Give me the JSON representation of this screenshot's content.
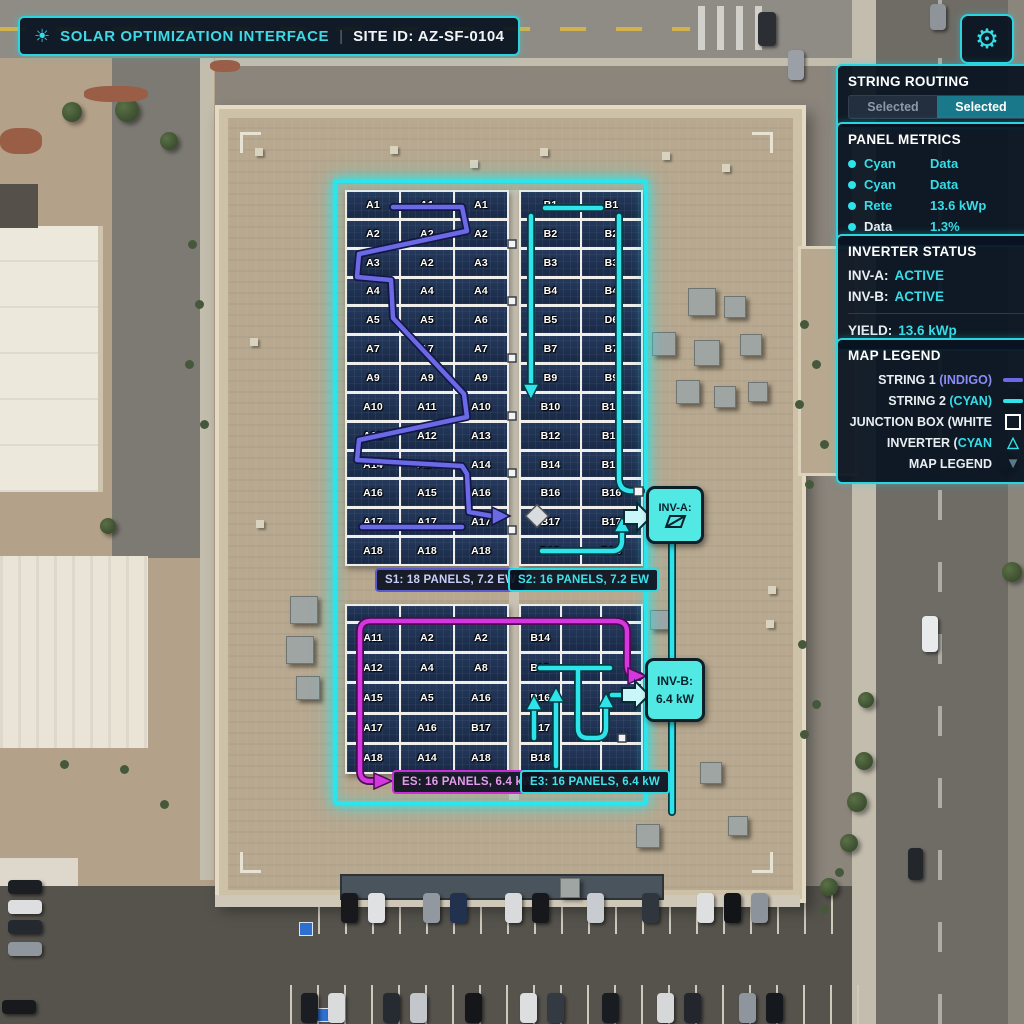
{
  "header": {
    "title": "SOLAR OPTIMIZATION INTERFACE",
    "separator": "|",
    "site": "SITE ID: AZ-SF-0104"
  },
  "icons": {
    "sun": "☀",
    "gear": "⚙",
    "triangle_outline": "△",
    "triangle_fill": "▼"
  },
  "colors": {
    "cyan": "#2ee3ea",
    "indigo": "#6a6ae4",
    "magenta": "#d437de",
    "hud_bg": "#081220"
  },
  "string_routing": {
    "title": "STRING ROUTING",
    "buttons": [
      {
        "label": "Selected",
        "active": false
      },
      {
        "label": "Selected",
        "active": true
      }
    ]
  },
  "panel_metrics": {
    "title": "PANEL METRICS",
    "rows": [
      {
        "label": "Cyan",
        "value": "Data"
      },
      {
        "label": "Cyan",
        "value": "Data"
      },
      {
        "label": "Rete",
        "value": "13.6 kWp"
      },
      {
        "label": "Data",
        "value": "1.3%"
      }
    ]
  },
  "inverter_status": {
    "title": "INVERTER STATUS",
    "rows": [
      {
        "label": "INV-A:",
        "value": "ACTIVE"
      },
      {
        "label": "INV-B:",
        "value": "ACTIVE"
      }
    ],
    "yield_label": "YIELD:",
    "yield_value": "13.6 kWp"
  },
  "map_legend": {
    "title": "MAP LEGEND",
    "entries": [
      {
        "label": "STRING 1 ",
        "colorText": "(INDIGO)"
      },
      {
        "label": "STRING 2 ",
        "colorText": "(CYAN)"
      },
      {
        "label": "JUNCTION BOX (WHITE",
        "colorText": ""
      },
      {
        "label": "INVERTER (",
        "colorText": "CYAN"
      },
      {
        "label": "MAP LEGEND",
        "colorText": ""
      }
    ]
  },
  "inverters": {
    "a": {
      "label": "INV-A:"
    },
    "b": {
      "label": "INV-B:",
      "value": "6.4 kW"
    }
  },
  "strings": {
    "s1": {
      "label": "S1: 18 PANELS, 7.2 EW",
      "cells": [
        [
          "A1",
          "A1",
          "A1"
        ],
        [
          "A2",
          "A2",
          "A2"
        ],
        [
          "A3",
          "A2",
          "A3"
        ],
        [
          "A4",
          "A4",
          "A4"
        ],
        [
          "A5",
          "A5",
          "A6"
        ],
        [
          "A7",
          "A7",
          "A7"
        ],
        [
          "A9",
          "A9",
          "A9"
        ],
        [
          "A10",
          "A11",
          "A10"
        ],
        [
          "A12",
          "A12",
          "A13"
        ],
        [
          "A14",
          "A14",
          "A14"
        ],
        [
          "A16",
          "A15",
          "A16"
        ],
        [
          "A17",
          "A17",
          "A17"
        ],
        [
          "A18",
          "A18",
          "A18"
        ]
      ]
    },
    "s2": {
      "label": "S2: 16 PANELS, 7.2 EW",
      "cells": [
        [
          "B1",
          "B1"
        ],
        [
          "B2",
          "B2"
        ],
        [
          "B3",
          "B3"
        ],
        [
          "B4",
          "B4"
        ],
        [
          "B5",
          "D6"
        ],
        [
          "B7",
          "B7"
        ],
        [
          "B9",
          "B9"
        ],
        [
          "B10",
          "B10"
        ],
        [
          "B12",
          "B11"
        ],
        [
          "B14",
          "B15"
        ],
        [
          "B16",
          "B16"
        ],
        [
          "B17",
          "B17"
        ],
        [
          "D18",
          "B18"
        ]
      ]
    },
    "s3": {
      "label": "ES: 16 PANELS, 6.4 kW",
      "cells": [
        [
          "",
          "",
          ""
        ],
        [
          "A11",
          "A2",
          "A2"
        ],
        [
          "A12",
          "A4",
          "A8"
        ],
        [
          "A15",
          "A5",
          "A16"
        ],
        [
          "A17",
          "A16",
          "B17"
        ],
        [
          "A18",
          "A14",
          "A18"
        ]
      ]
    },
    "e3": {
      "label": "E3: 16 PANELS, 6.4 kW",
      "cells": [
        [
          "",
          "",
          ""
        ],
        [
          "B14",
          "",
          ""
        ],
        [
          "B15",
          "",
          ""
        ],
        [
          "B16",
          "",
          ""
        ],
        [
          "B17",
          "",
          ""
        ],
        [
          "B18",
          "",
          ""
        ]
      ]
    }
  }
}
